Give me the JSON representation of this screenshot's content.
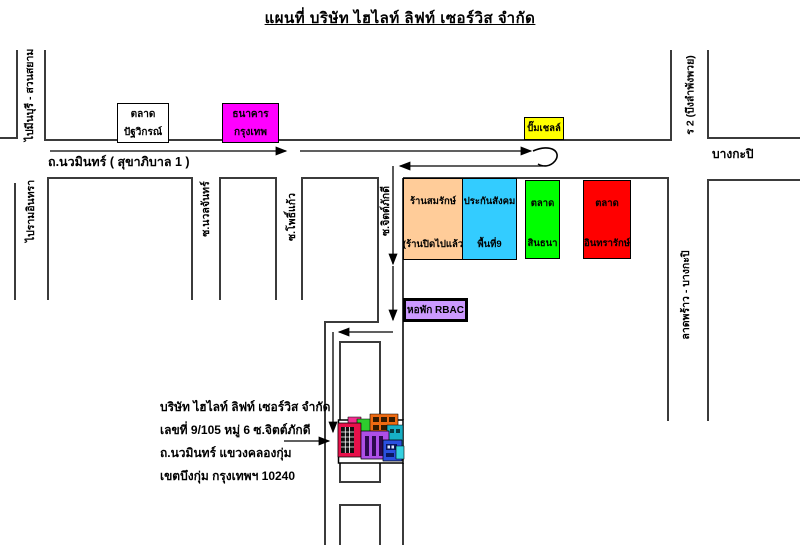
{
  "title": "แผนที่ บริษัท ไฮไลท์ ลิฟท์ เซอร์วิส จำกัด",
  "roads": {
    "nawamin": "ถ.นวมินทร์ ( สุขาภิบาล 1 )",
    "bangkapi": "บางกะปิ",
    "to_minburi": "ไปมีนบุรี - สวนสยาม",
    "to_ramindra": "ไปรามอินทรา",
    "soi_nuanchan": "ซ.นวลจันทร์",
    "soi_phokaew": "ซ.โพธิ์แก้ว",
    "soi_chitphakdi": "ซ.จิตต์ภักดี",
    "ring2": "ร 2 (บึงลำพังพวย)",
    "latphrao_bangkapi": "ลาดพร้าว - บางกะปิ"
  },
  "landmarks": {
    "market_patwikorn": {
      "line1": "ตลาด",
      "line2": "ปัฐวิกรณ์",
      "color": "#FFFFFF"
    },
    "bank_bangkok": {
      "line1": "ธนาคาร",
      "line2": "กรุงเทพ",
      "color": "#FF00FF"
    },
    "shell_station": {
      "label": "ปั๊มเชลล์",
      "color": "#FFFF00"
    },
    "somrak_shop": {
      "line1": "ร้านสมรักษ์",
      "line2": "(ร้านปิดไปแล้ว",
      "color": "#FFCC99"
    },
    "social_security": {
      "line1": "ประกันสังคม",
      "line2": "พื้นที่9",
      "color": "#33CCFF"
    },
    "market_sinthana": {
      "line1": "ตลาด",
      "line2": "สินธนา",
      "color": "#00FF00"
    },
    "market_intararak": {
      "line1": "ตลาด",
      "line2": "อินทรารักษ์",
      "color": "#FF0000"
    },
    "rbac_dorm": {
      "label": "หอพัก RBAC",
      "color": "#CC99FF"
    }
  },
  "address": {
    "line1": "บริษัท ไฮไลท์ ลิฟท์ เซอร์วิส จำกัด",
    "line2": "เลขที่ 9/105 หมู่ 6 ซ.จิตต์ภักดี",
    "line3": "ถ.นวมินทร์ แขวงคลองกุ่ม",
    "line4": "เขตบึงกุ่ม กรุงเทพฯ 10240"
  },
  "colors": {
    "road_line": "#3b3b3b",
    "arrow": "#000000"
  }
}
